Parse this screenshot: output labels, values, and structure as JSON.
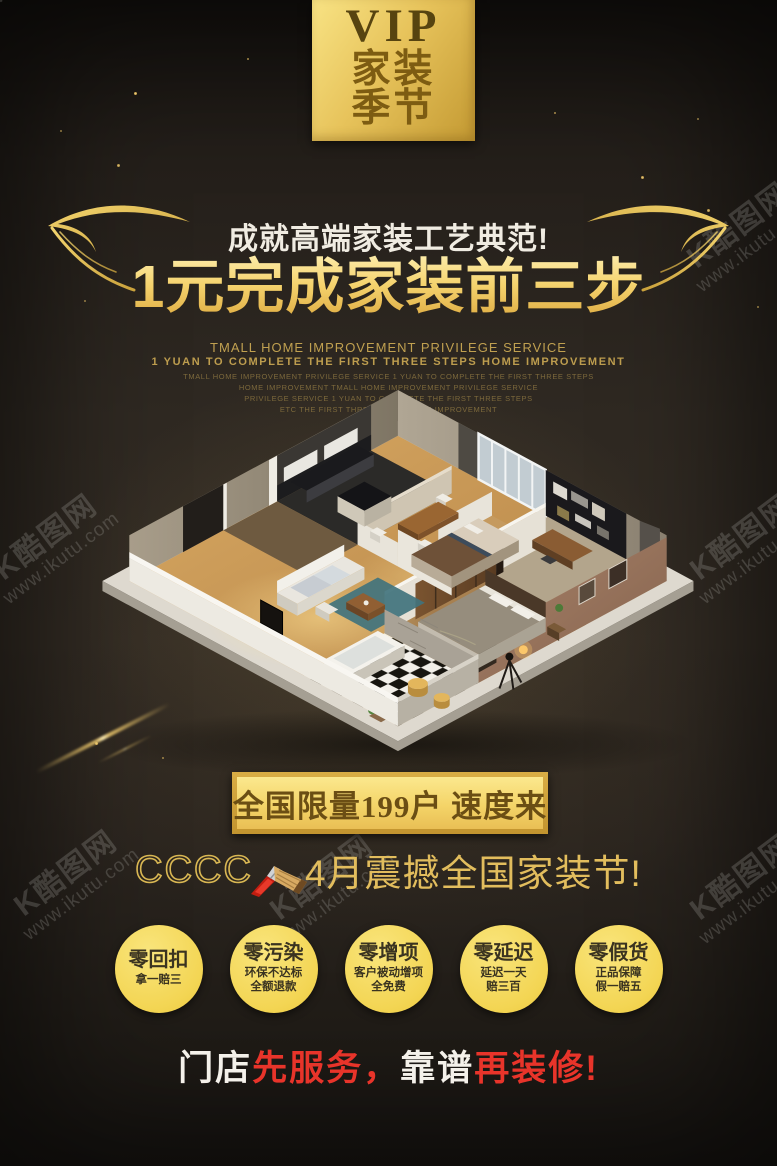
{
  "badge": {
    "top": "VIP",
    "row1": "家装",
    "row2": "季节"
  },
  "header": {
    "subtitle": "成就高端家装工艺典范!",
    "title": "1元完成家装前三步",
    "en_line1": "TMALL HOME IMPROVEMENT PRIVILEGE SERVICE",
    "en_line2": "1 YUAN TO COMPLETE THE FIRST THREE STEPS HOME IMPROVEMENT",
    "en_small": [
      "TMALL HOME IMPROVEMENT PRIVILEGE SERVICE 1 YUAN TO COMPLETE THE FIRST THREE STEPS",
      "HOME IMPROVEMENT TMALL HOME IMPROVEMENT PRIVILEGE SERVICE",
      "PRIVILEGE SERVICE 1 YUAN TO COMPLETE THE FIRST THREE STEPS",
      "ETC THE FIRST THREE STEPS HOME IMPROVEMENT"
    ]
  },
  "hero": {
    "alt": "3D isometric cutaway render of a furnished apartment floor plan"
  },
  "cta": {
    "label": "全国限量199户 速度来"
  },
  "event": {
    "prefix": "CCCC",
    "brush_icon": "paint-brush-icon",
    "text": "4月震撼全国家装节!"
  },
  "promises": [
    {
      "title": "零回扣",
      "lines": [
        "拿一赔三",
        ""
      ]
    },
    {
      "title": "零污染",
      "lines": [
        "环保不达标",
        "全额退款"
      ]
    },
    {
      "title": "零增项",
      "lines": [
        "客户被动增项",
        "全免费"
      ]
    },
    {
      "title": "零延迟",
      "lines": [
        "延迟一天",
        "赔三百"
      ]
    },
    {
      "title": "零假货",
      "lines": [
        "正品保障",
        "假一赔五"
      ]
    }
  ],
  "slogan": {
    "parts": [
      {
        "text": "门店",
        "color": "white"
      },
      {
        "text": "先服务，",
        "color": "red"
      },
      {
        "text": "靠谱",
        "color": "white"
      },
      {
        "text": "再装修!",
        "color": "red"
      }
    ]
  },
  "watermark": {
    "line1": "K酷图网",
    "line2": "www.ikutu.com"
  },
  "colors": {
    "gold": "#e9c45c",
    "circle_yellow": "#f3d553",
    "red": "#e8342a",
    "badge_gold": "#e7c35b"
  }
}
